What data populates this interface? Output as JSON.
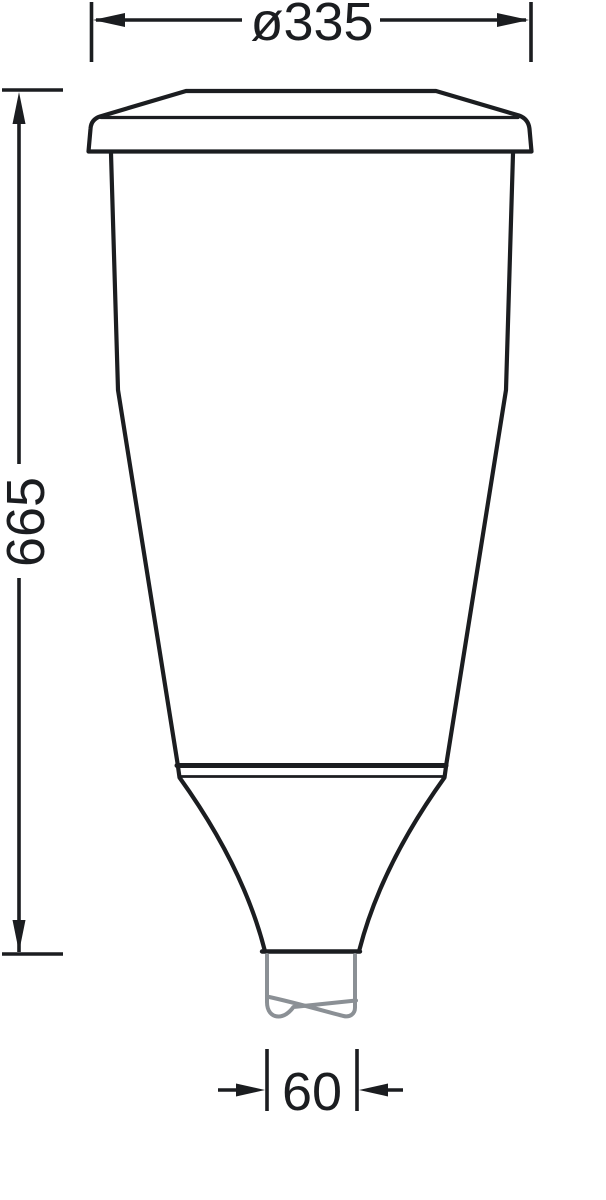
{
  "drawing": {
    "dimensions": {
      "diameter_top": {
        "label": "ø335"
      },
      "height": {
        "label": "665"
      },
      "spigot": {
        "label": "60"
      }
    },
    "colors": {
      "line": "#1b1d20",
      "text": "#1b1d20",
      "pole": "#8b9095",
      "background": "#ffffff"
    }
  }
}
